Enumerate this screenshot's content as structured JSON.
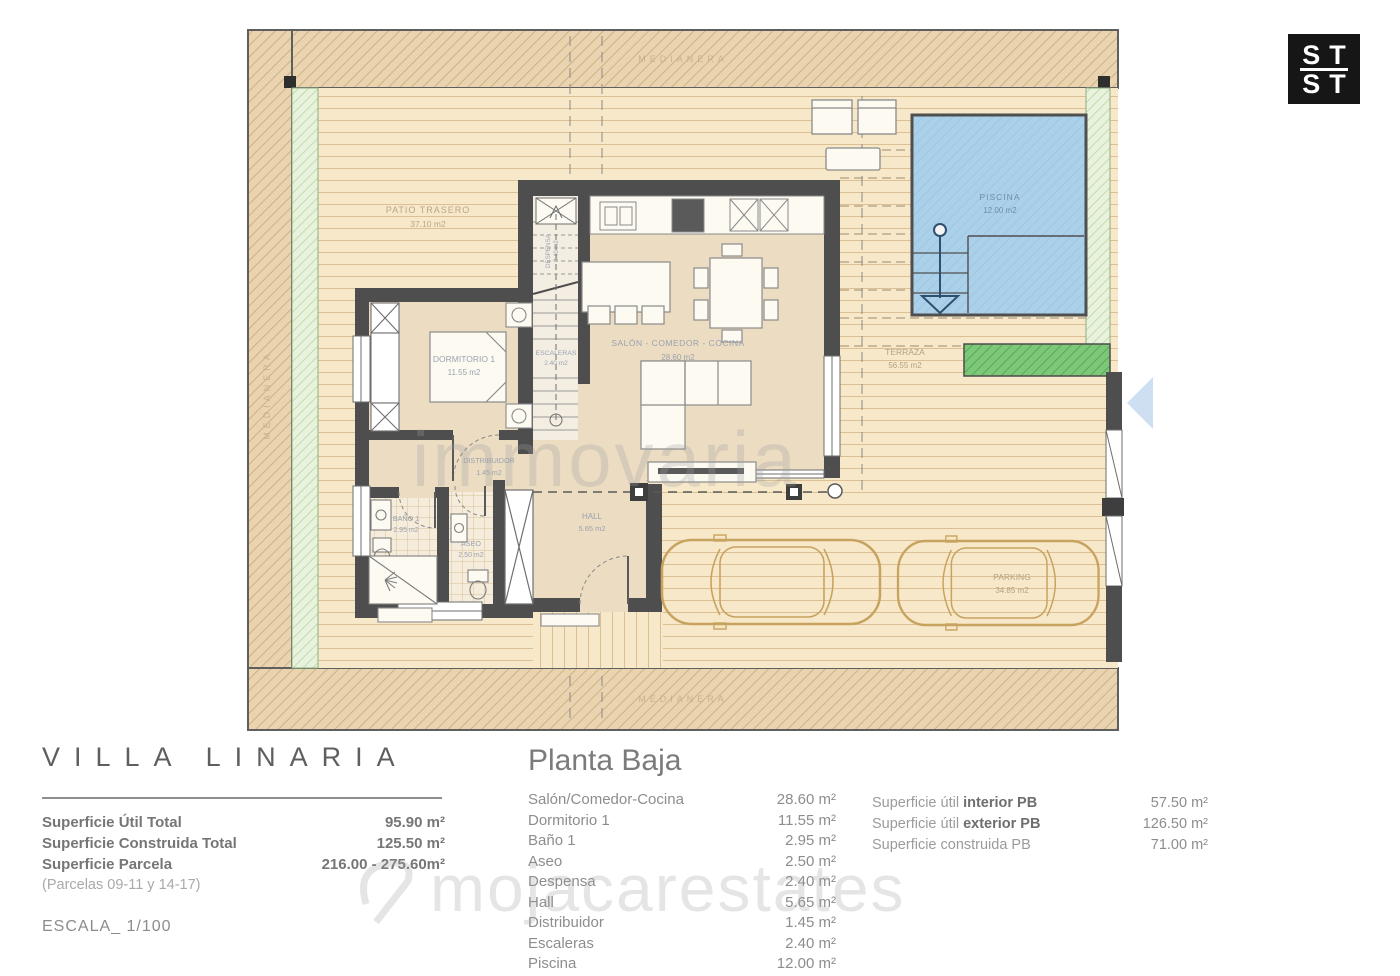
{
  "logo": {
    "top": "ST",
    "bottom": "ST"
  },
  "watermarks": {
    "center": "immovaria",
    "bottom": "mojacarestates"
  },
  "plan": {
    "boundary_label": "MEDIANERA",
    "rooms": {
      "patio": {
        "name": "PATIO TRASERO",
        "area": "37.10 m2"
      },
      "dormitorio": {
        "name": "DORMITORIO 1",
        "area": "11.55 m2"
      },
      "escalera": {
        "name": "ESCALERAS",
        "area": "2.40 m2"
      },
      "despensa": {
        "name": "DESPENSA",
        "area": "2.40 m2"
      },
      "salon": {
        "name": "SALÓN - COMEDOR - COCINA",
        "area": "28.60 m2"
      },
      "distribuidor": {
        "name": "DISTRIBUIDOR",
        "area": "1.45 m2"
      },
      "bano": {
        "name": "BAÑO 1",
        "area": "2.95 m2"
      },
      "aseo": {
        "name": "ASEO",
        "area": "2.50 m2"
      },
      "hall": {
        "name": "HALL",
        "area": "5.65 m2"
      },
      "terraza": {
        "name": "TERRAZA",
        "area": "56.55 m2"
      },
      "piscina": {
        "name": "PISCINA",
        "area": "12.00 m2"
      },
      "parking": {
        "name": "PARKING",
        "area": "34.85 m2"
      }
    }
  },
  "title_block": {
    "title": "VILLA LINARIA",
    "rows": [
      {
        "label": "Superficie Útil Total",
        "value": "95.90 m²"
      },
      {
        "label": "Superficie Construida Total",
        "value": "125.50 m²"
      },
      {
        "label": "Superficie Parcela",
        "value": "216.00 - 275.60m²"
      }
    ],
    "note": "(Parcelas 09-11 y 14-17)",
    "scale": "ESCALA_ 1/100"
  },
  "planta_baja": {
    "heading": "Planta Baja",
    "rows": [
      {
        "label": "Salón/Comedor-Cocina",
        "value": "28.60 m²"
      },
      {
        "label": "Dormitorio 1",
        "value": "11.55 m²"
      },
      {
        "label": "Baño 1",
        "value": "2.95 m²"
      },
      {
        "label": "Aseo",
        "value": "2.50 m²"
      },
      {
        "label": "Despensa",
        "value": "2.40 m²"
      },
      {
        "label": "Hall",
        "value": "5.65 m²"
      },
      {
        "label": "Distribuidor",
        "value": "1.45 m²"
      },
      {
        "label": "Escaleras",
        "value": "2.40 m²"
      },
      {
        "label": "Piscina",
        "value": "12.00 m²"
      }
    ]
  },
  "summary": {
    "rows": [
      {
        "label": "Superficie útil ",
        "bold": "interior PB",
        "value": "57.50 m²"
      },
      {
        "label": "Superficie útil ",
        "bold": "exterior PB",
        "value": "126.50 m²"
      },
      {
        "label": "Superficie construida PB",
        "bold": "",
        "value": "71.00 m²"
      }
    ]
  },
  "colors": {
    "band_beige": "#e9d4af",
    "deck_beige": "#f7e8ca",
    "pool_blue": "#abd1ea",
    "planter_green": "#7cc878",
    "hedge_light_green": "#e8f2dc",
    "wall_gray": "#4e4e4e",
    "car_tan": "#c8a35f",
    "entry_arrow_blue": "#cfdff2"
  }
}
